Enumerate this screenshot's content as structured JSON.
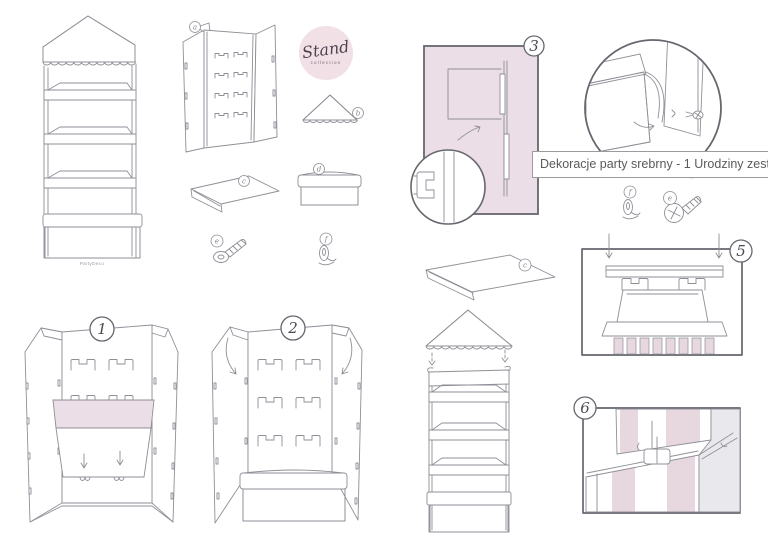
{
  "page": {
    "title": "Stand sweets display – assembly instructions"
  },
  "logo": {
    "name": "Stand",
    "subtitle": "collection"
  },
  "brand": {
    "footer_text": "PartyDeco"
  },
  "tooltip": {
    "text": "Dekoracje party srebrny - 1 Urodziny zestaw"
  },
  "step_numbers": {
    "one": "1",
    "two": "2",
    "three": "3",
    "five": "5",
    "six": "6"
  },
  "part_labels": {
    "panel": "a",
    "awning": "b",
    "shelf": "c",
    "box": "d",
    "screw": "e",
    "clip": "f"
  },
  "theme": {
    "pink_fill": "#ebdee6",
    "stripe_pink": "#e7d8e0",
    "line": "#8f8f97",
    "frame": "#66666e",
    "gray_panel": "#e9e9ed",
    "logo_bg": "#f2e0e7",
    "tooltip_border": "#9b9b9b",
    "tooltip_text": "#5a5a5a",
    "num_ink": "#4a4a52",
    "label_ink": "#8a848e",
    "brand_ink": "#9a9aa0"
  }
}
